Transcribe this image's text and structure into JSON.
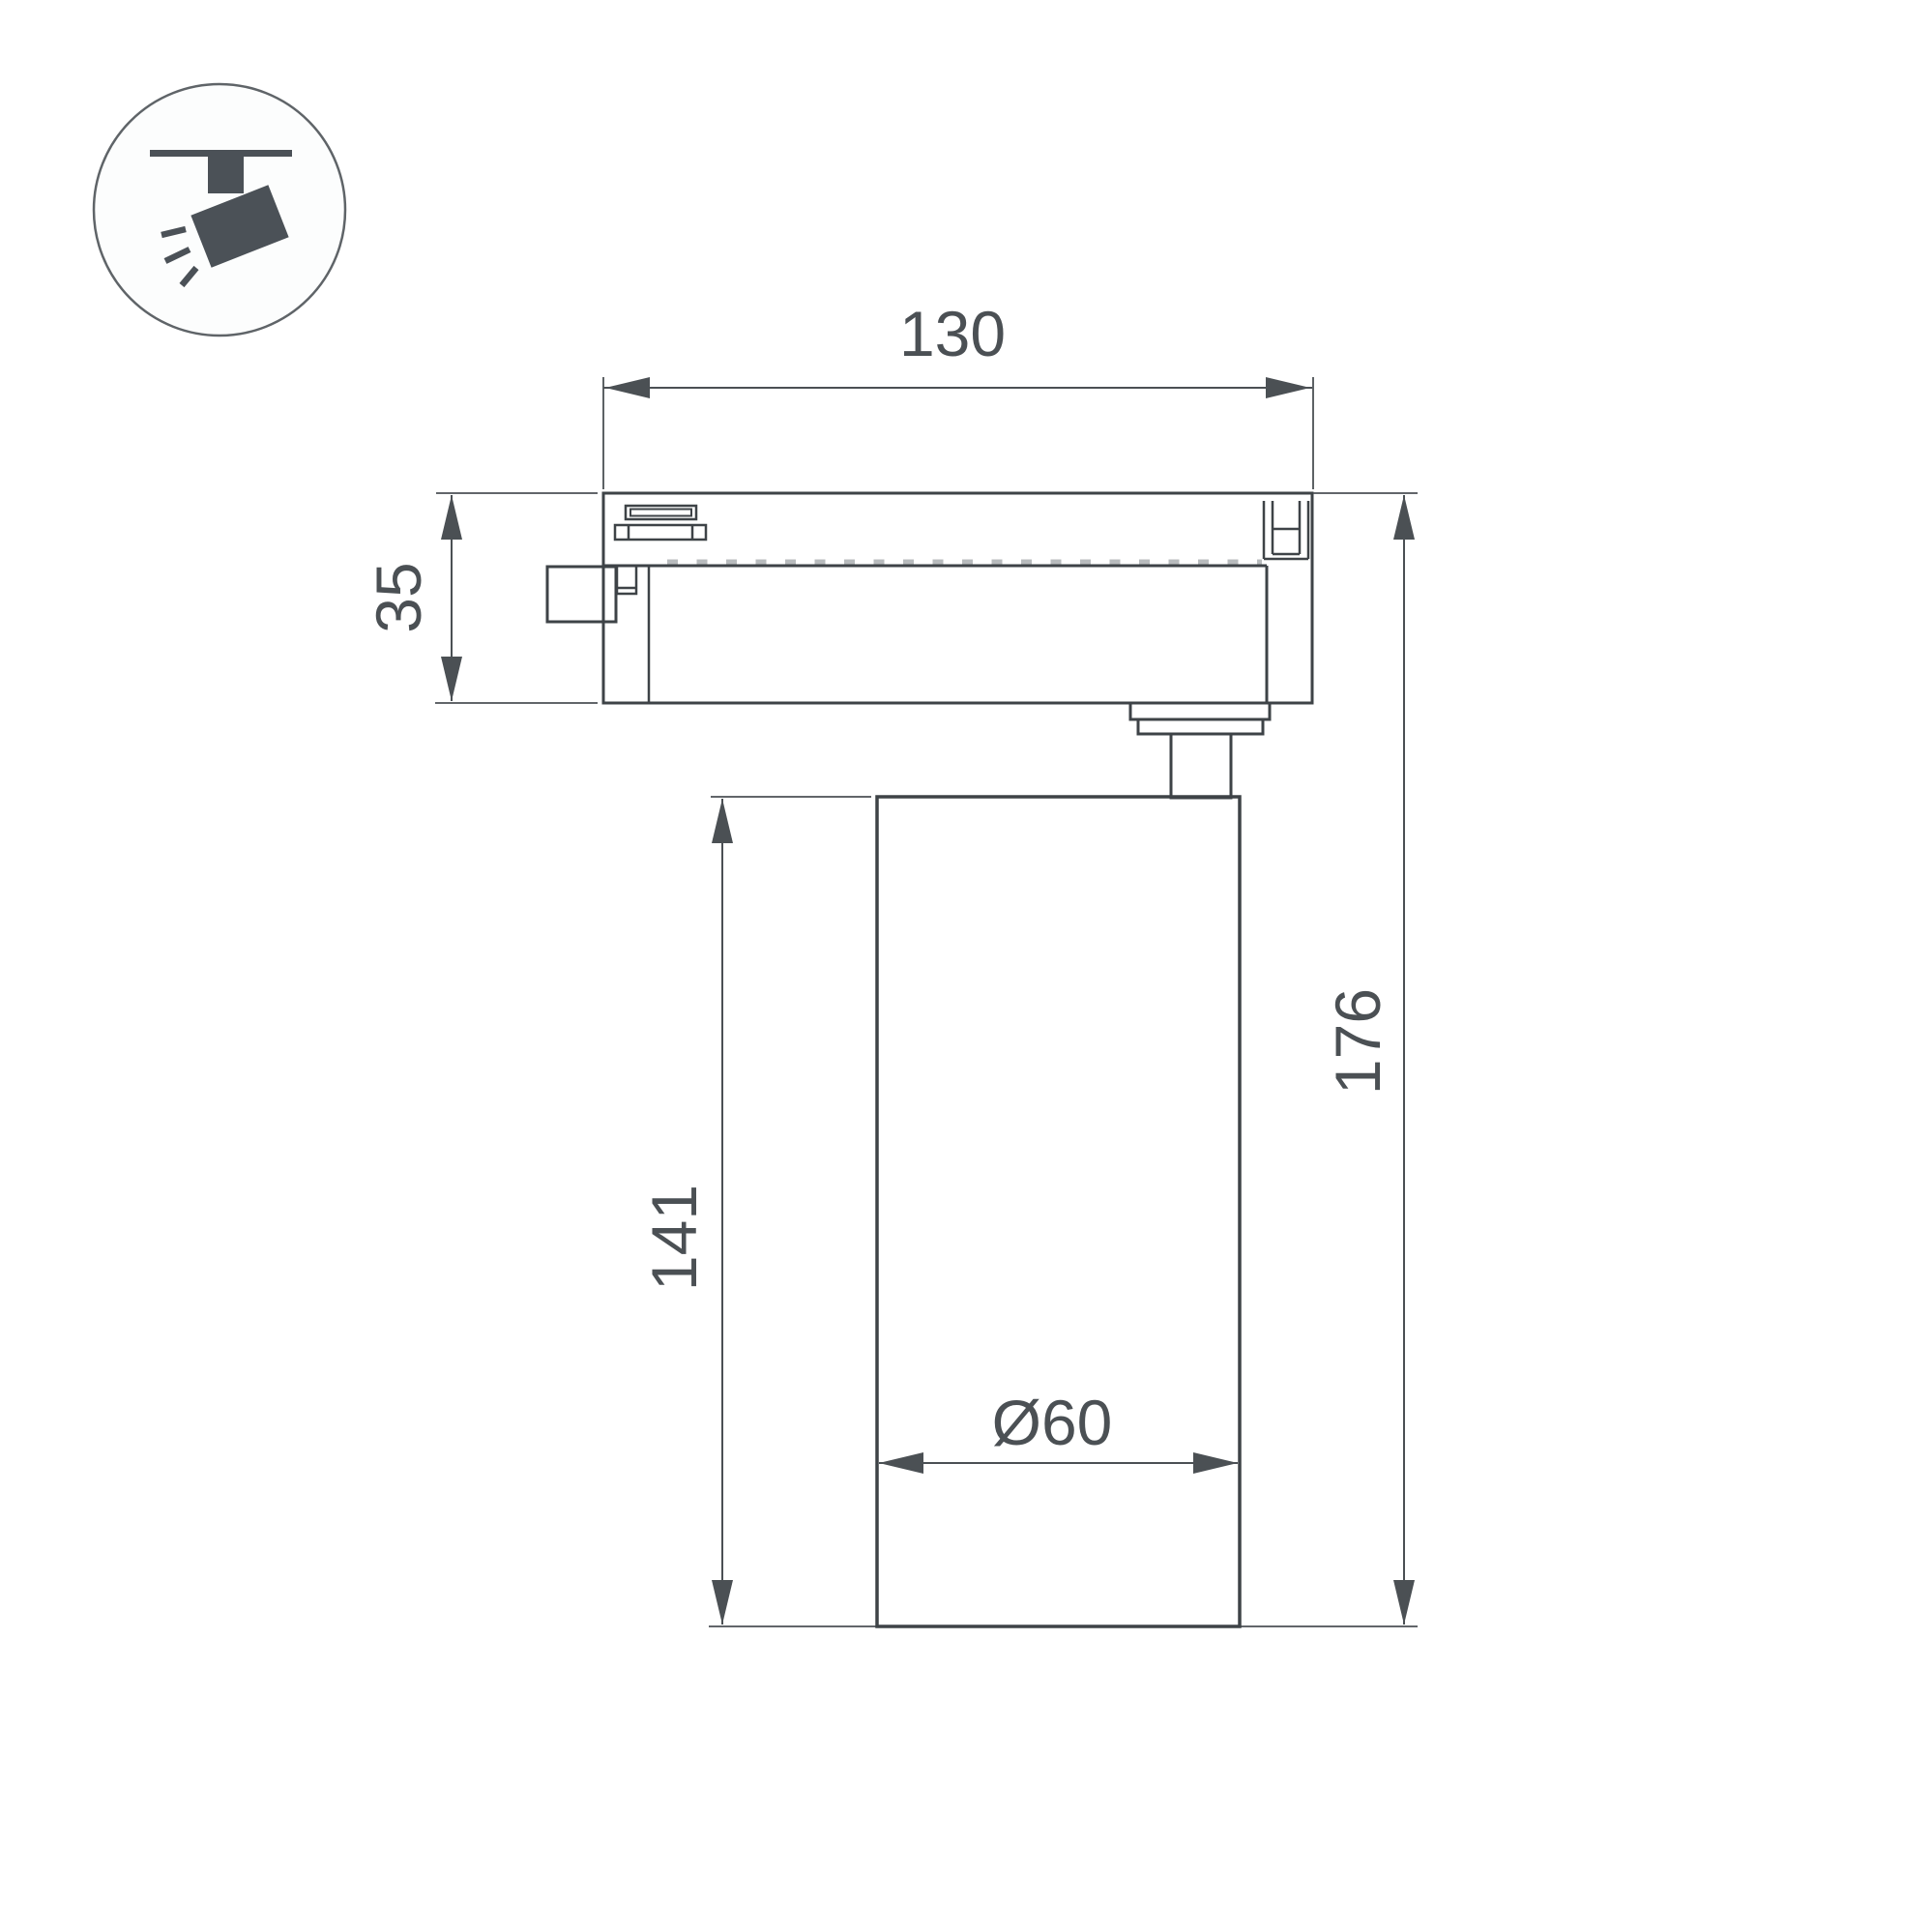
{
  "colors": {
    "outline": "#3e4347",
    "dimension": "#4b5054",
    "icon": "#4b5157",
    "tick": "#b8bbbd",
    "circle_stroke": "#5f6468"
  },
  "icons": {
    "badge": "track-spotlight-icon"
  },
  "dimensions": {
    "track_width": "130",
    "adapter_height": "35",
    "body_height": "141",
    "total_height": "176",
    "body_diameter": "Ø60"
  }
}
